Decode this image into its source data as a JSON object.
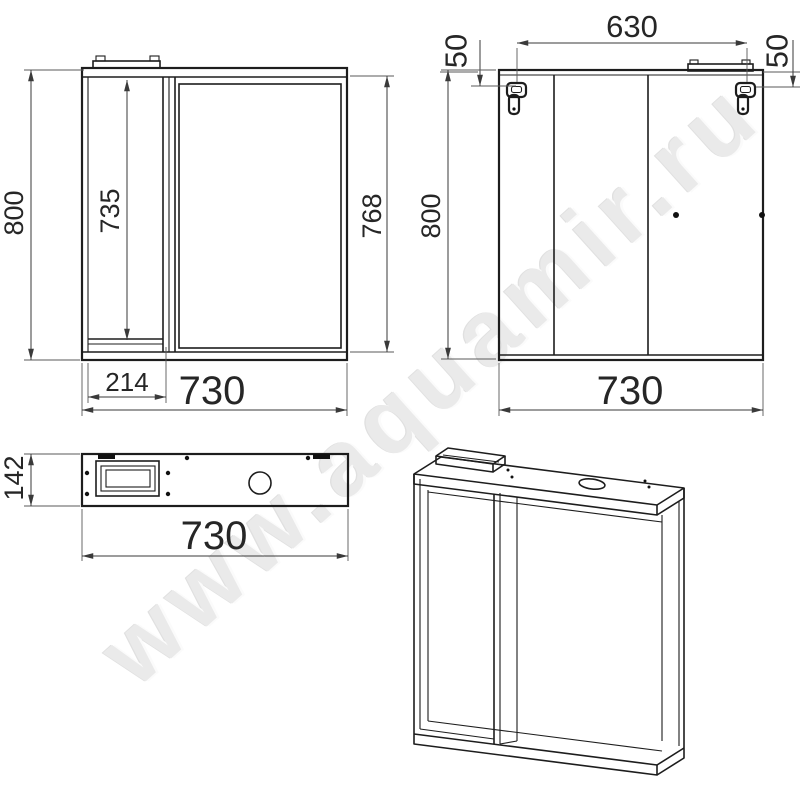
{
  "watermark": {
    "text": "www.aquamir.ru"
  },
  "front_view": {
    "dim_height": "800",
    "dim_door_height": "735",
    "dim_mirror_height": "768",
    "dim_left_section_width": "214",
    "dim_width": "730"
  },
  "back_view": {
    "dim_hook_spacing": "630",
    "dim_hook_offset_left": "50",
    "dim_hook_offset_right": "50",
    "dim_height": "800",
    "dim_width": "730"
  },
  "top_view": {
    "dim_depth": "142",
    "dim_width": "730"
  }
}
